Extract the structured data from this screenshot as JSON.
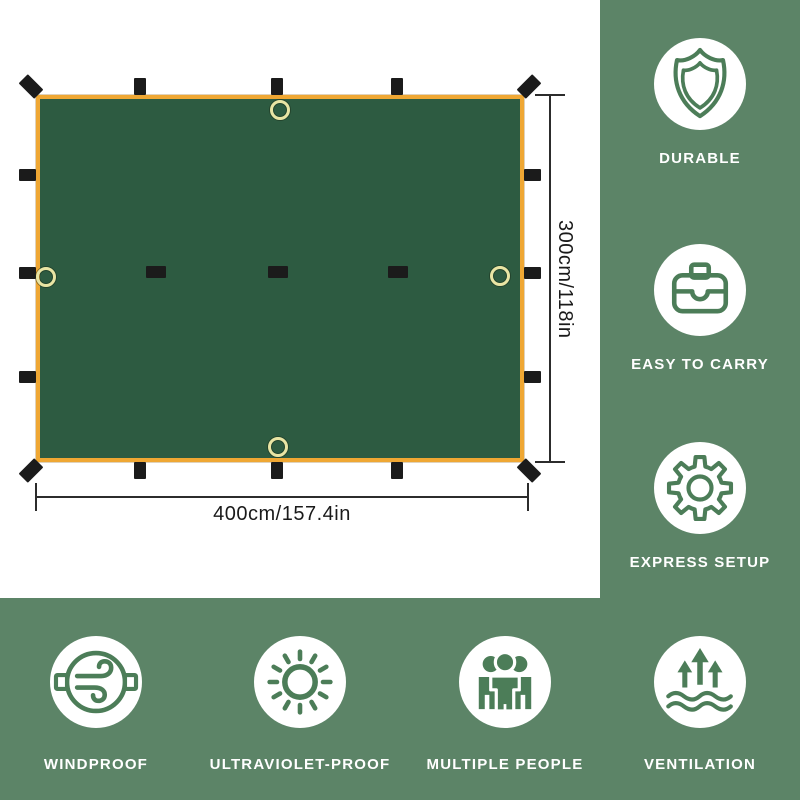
{
  "tarp_diagram": {
    "width_label": "400cm/157.4in",
    "height_label": "300cm/118in",
    "fabric_color": "#2d5b41",
    "edge_color": "#efa733",
    "tab_color": "#1b1b1b",
    "grommet_color": "#e9e5a4"
  },
  "features_right": [
    {
      "label": "DURABLE",
      "icon": "shield-icon"
    },
    {
      "label": "EASY TO CARRY",
      "icon": "briefcase-icon"
    },
    {
      "label": "EXPRESS SETUP",
      "icon": "gear-icon"
    }
  ],
  "features_bottom": [
    {
      "label": "WINDPROOF",
      "icon": "wind-icon"
    },
    {
      "label": "ULTRAVIOLET-PROOF",
      "icon": "sun-icon"
    },
    {
      "label": "MULTIPLE PEOPLE",
      "icon": "people-icon"
    },
    {
      "label": "VENTILATION",
      "icon": "ventilation-icon"
    }
  ],
  "theme": {
    "panel_green": "#5c8467",
    "icon_green": "#4c7d58",
    "label_color": "#ffffff",
    "dimension_text_color": "#1a1a1a",
    "background": "#ffffff"
  }
}
